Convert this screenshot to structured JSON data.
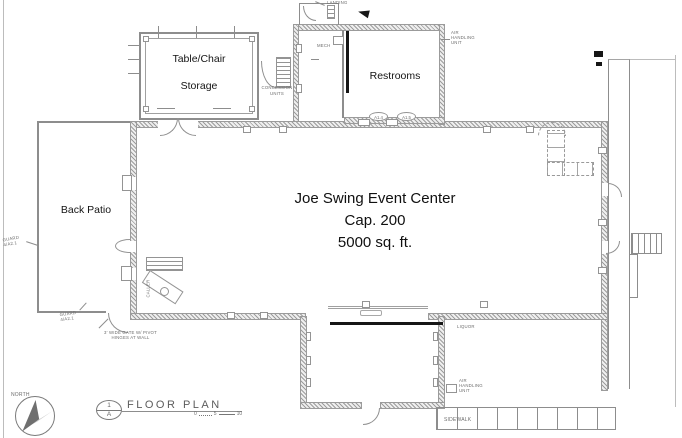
{
  "center": {
    "l1": "Joe Swing Event Center",
    "l2": "Cap. 200",
    "l3": "5000 sq. ft."
  },
  "rooms": {
    "storage_l1": "Table/Chair",
    "storage_l2": "Storage",
    "restrooms": "Restrooms",
    "back_patio": "Back Patio",
    "landing": "LANDING",
    "mech": "MECH",
    "liquor": "LIQUOR",
    "caller": "CALLER"
  },
  "annotations": {
    "air_l1": "AIR",
    "air_l2": "HANDLING",
    "air_l3": "UNIT",
    "concession_l1": "CONCESSION",
    "concession_l2": "UNITS",
    "guard_l1": "GUARD",
    "guard_l2": "4/A2.1",
    "gate_l1": "3' WIDE GATE W/ PIVOT",
    "gate_l2": "HINGES AT WALL",
    "tag1": "A1.4",
    "tag2": "A1.5",
    "sidewalk": "SIDEWALK"
  },
  "titleblock": {
    "north": "NORTH",
    "bubble_num": "1",
    "bubble_sheet": "A",
    "title": "FLOOR PLAN",
    "scale_0": "0",
    "scale_5": "5",
    "scale_10": "10"
  },
  "colors": {
    "line": "#8d8d8d",
    "text_dark": "#141414",
    "tiny_text": "#6d6d6d"
  }
}
